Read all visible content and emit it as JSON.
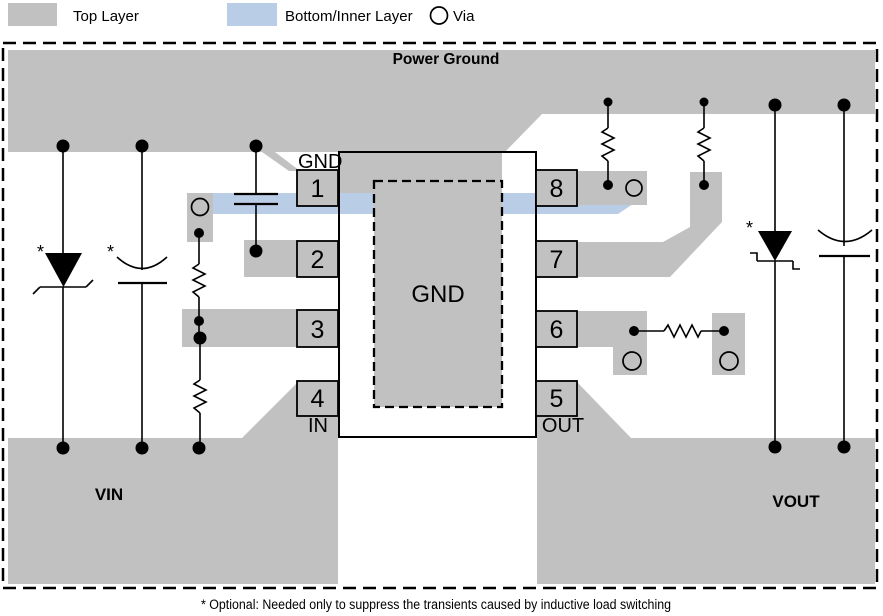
{
  "colors": {
    "top_layer": "#C1C1C1",
    "bottom_inner_layer": "#B9CDE6",
    "outline": "#000000",
    "background": "#FFFFFF"
  },
  "legend": {
    "top_layer_label": "Top Layer",
    "bottom_inner_layer_label": "Bottom/Inner Layer",
    "via_label": "Via"
  },
  "board": {
    "power_ground_label": "Power Ground",
    "vin_label": "VIN",
    "vout_label": "VOUT",
    "optional_marker": "*",
    "footnote": "* Optional: Needed only to suppress the transients caused by inductive load switching"
  },
  "ic": {
    "gnd_pin_label": "GND",
    "thermal_pad_label": "GND",
    "in_pin_label": "IN",
    "out_pin_label": "OUT",
    "pins": [
      {
        "number": "1"
      },
      {
        "number": "2"
      },
      {
        "number": "3"
      },
      {
        "number": "4"
      },
      {
        "number": "5"
      },
      {
        "number": "6"
      },
      {
        "number": "7"
      },
      {
        "number": "8"
      }
    ]
  }
}
